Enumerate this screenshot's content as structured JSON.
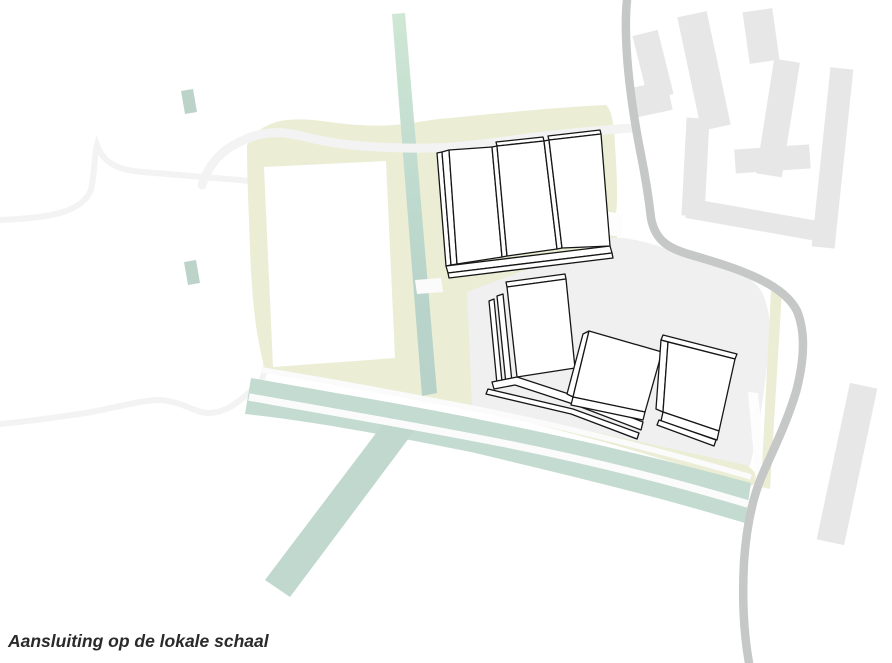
{
  "figure": {
    "caption": "Aansluiting op de lokale schaal"
  },
  "colors": {
    "site_yellow": "#ebeed5",
    "corridor_teal": "#c3dbd1",
    "branch_teal": "#c0d8cd",
    "strip_teal": "#b9d4ca",
    "strip_mint": "#cfe7d4",
    "fragment_teal": "#bcd3ca",
    "plaza_gray": "#f0f0f1",
    "context_gray": "#e7e7e8",
    "road_dark_gray": "#c6c7c7",
    "road_faint_gray": "#f3f3f4",
    "white_road": "#fbfbfc",
    "building_fill": "#ffffff",
    "building_outline": "#161616",
    "caption_text": "#2a2a2a"
  }
}
